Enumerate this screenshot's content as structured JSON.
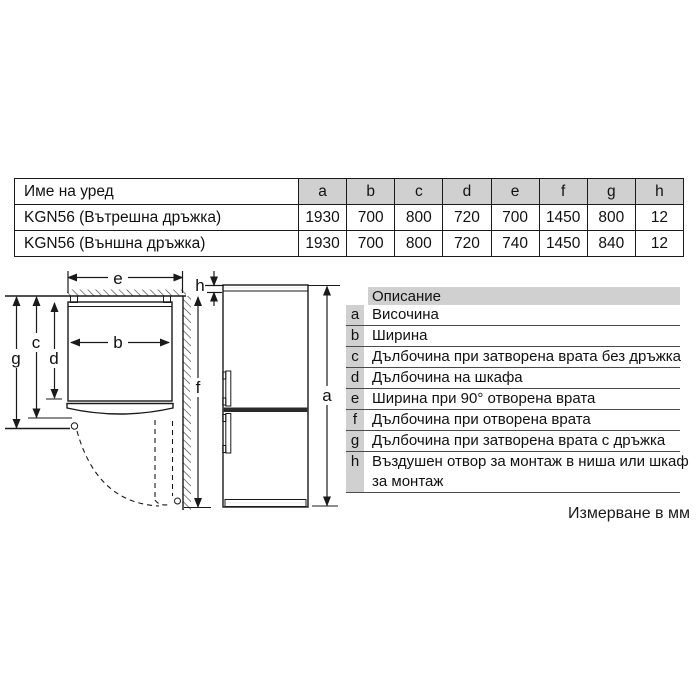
{
  "spec_table": {
    "name_header": "Име на уред",
    "dim_headers": [
      "a",
      "b",
      "c",
      "d",
      "e",
      "f",
      "g",
      "h"
    ],
    "rows": [
      {
        "name": "KGN56 (Вътрешна дръжка)",
        "values": [
          "1930",
          "700",
          "800",
          "720",
          "700",
          "1450",
          "800",
          "12"
        ]
      },
      {
        "name": "KGN56 (Външна дръжка)",
        "values": [
          "1930",
          "700",
          "800",
          "720",
          "740",
          "1450",
          "840",
          "12"
        ]
      }
    ]
  },
  "legend": {
    "header": "Описание",
    "rows": [
      {
        "letter": "a",
        "text": "Височина"
      },
      {
        "letter": "b",
        "text": "Ширина"
      },
      {
        "letter": "c",
        "text": "Дълбочина при затворена врата без дръжка"
      },
      {
        "letter": "d",
        "text": "Дълбочина на шкафа"
      },
      {
        "letter": "e",
        "text": "Ширина при 90° отворена врата"
      },
      {
        "letter": "f",
        "text": "Дълбочина при отворена врата"
      },
      {
        "letter": "g",
        "text": "Дълбочина при затворена врата с дръжка"
      },
      {
        "letter": "h",
        "text": "Въздушен отвор за монтаж в ниша или шкаф\nза монтаж"
      }
    ]
  },
  "diagram": {
    "labels": {
      "a": "a",
      "b": "b",
      "c": "c",
      "d": "d",
      "e": "e",
      "f": "f",
      "g": "g",
      "h": "h"
    }
  },
  "footer_note": "Измерване в мм",
  "colors": {
    "table_header_bg": "#d0d0d0",
    "legend_shade_bg": "#d0d0d0",
    "fridge_trim": "#c9c9c9",
    "line": "#1a1a1a"
  }
}
